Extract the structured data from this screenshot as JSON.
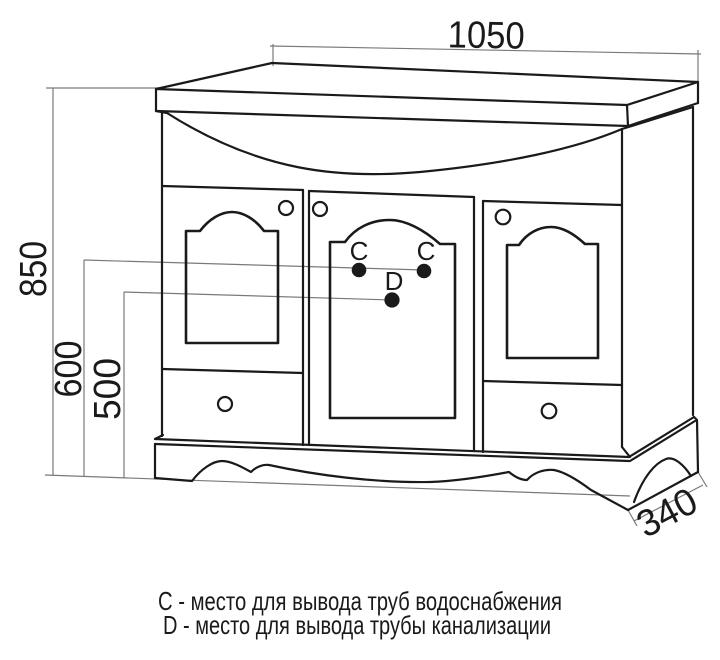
{
  "diagram": {
    "dimensions": {
      "width": "1050",
      "height": "850",
      "supply_height": "600",
      "drain_height": "500",
      "depth": "340"
    },
    "markers": {
      "c_left": "C",
      "c_right": "C",
      "d": "D"
    },
    "legend": {
      "line_c": "C - место для вывода труб водоснабжения",
      "line_d": "D - место для вывода трубы канализации"
    },
    "colors": {
      "line": "#1a1a1a",
      "dim": "#7a7a7a",
      "background": "#ffffff"
    }
  }
}
